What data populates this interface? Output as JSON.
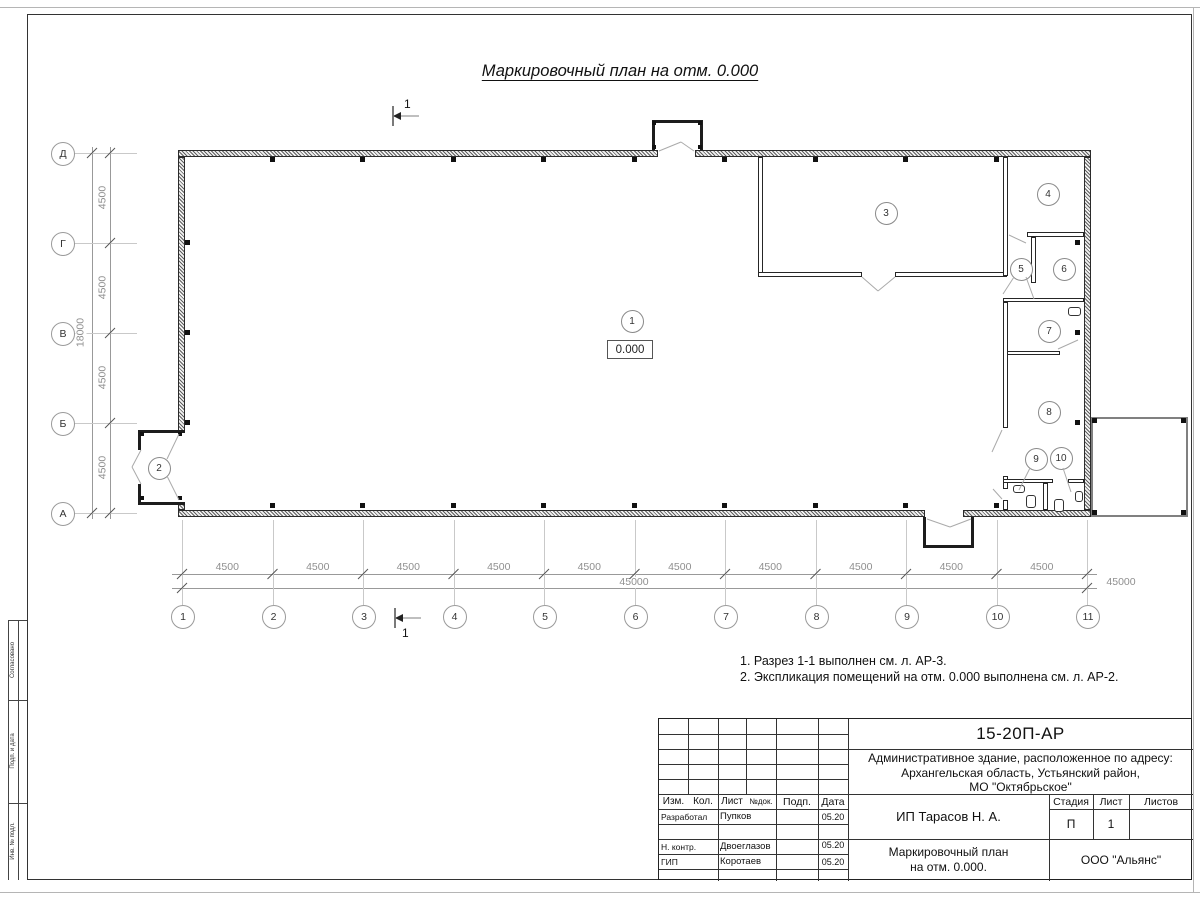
{
  "sheet": {
    "title": "Маркировочный план на отм. 0.000",
    "elevation_mark": "0.000",
    "section_mark": "1",
    "notes": [
      "1. Разрез 1-1 выполнен см. л. АР-3.",
      "2. Экспликация помещений на отм. 0.000 выполнена см. л. АР-2."
    ]
  },
  "axes": {
    "horizontal": [
      "1",
      "2",
      "3",
      "4",
      "5",
      "6",
      "7",
      "8",
      "9",
      "10",
      "11"
    ],
    "vertical": [
      "Д",
      "Г",
      "В",
      "Б",
      "А"
    ]
  },
  "dimensions": {
    "bottom_segments": [
      "4500",
      "4500",
      "4500",
      "4500",
      "4500",
      "4500",
      "4500",
      "4500",
      "4500",
      "4500"
    ],
    "bottom_total": "45000",
    "left_segments": [
      "4500",
      "4500",
      "4500",
      "4500"
    ],
    "left_total": "18000"
  },
  "rooms": [
    "1",
    "2",
    "3",
    "4",
    "5",
    "6",
    "7",
    "8",
    "9",
    "10"
  ],
  "title_block": {
    "doc_number": "15-20П-АР",
    "project_address_lines": [
      "Административное здание, расположенное по адресу:",
      "Архангельская область, Устьянский район,",
      "МО \"Октябрьское\""
    ],
    "columns": {
      "izm": "Изм.",
      "kol": "Кол.",
      "list": "Лист",
      "ndok": "№док.",
      "podp": "Подп.",
      "data": "Дата"
    },
    "signature_rows": [
      {
        "role": "Разработал",
        "name": "Пупков",
        "date": "05.20"
      },
      {
        "role": "Н. контр.",
        "name": "Двоеглазов",
        "date": "05.20"
      },
      {
        "role": "ГИП",
        "name": "Коротаев",
        "date": "05.20"
      }
    ],
    "client": "ИП Тарасов Н. А.",
    "stage_label": "Стадия",
    "sheet_label": "Лист",
    "sheets_label": "Листов",
    "stage_value": "П",
    "sheet_value": "1",
    "sheets_value": "",
    "drawing_title_lines": [
      "Маркировочный план",
      "на отм. 0.000."
    ],
    "company": "ООО \"Альянс\""
  },
  "side_column_labels": [
    "Согласовано",
    "Подп. и дата",
    "Инв. № подл."
  ],
  "colors": {
    "line_dark": "#222222",
    "line_dim": "#999999",
    "wall_hatch": "#606060"
  }
}
